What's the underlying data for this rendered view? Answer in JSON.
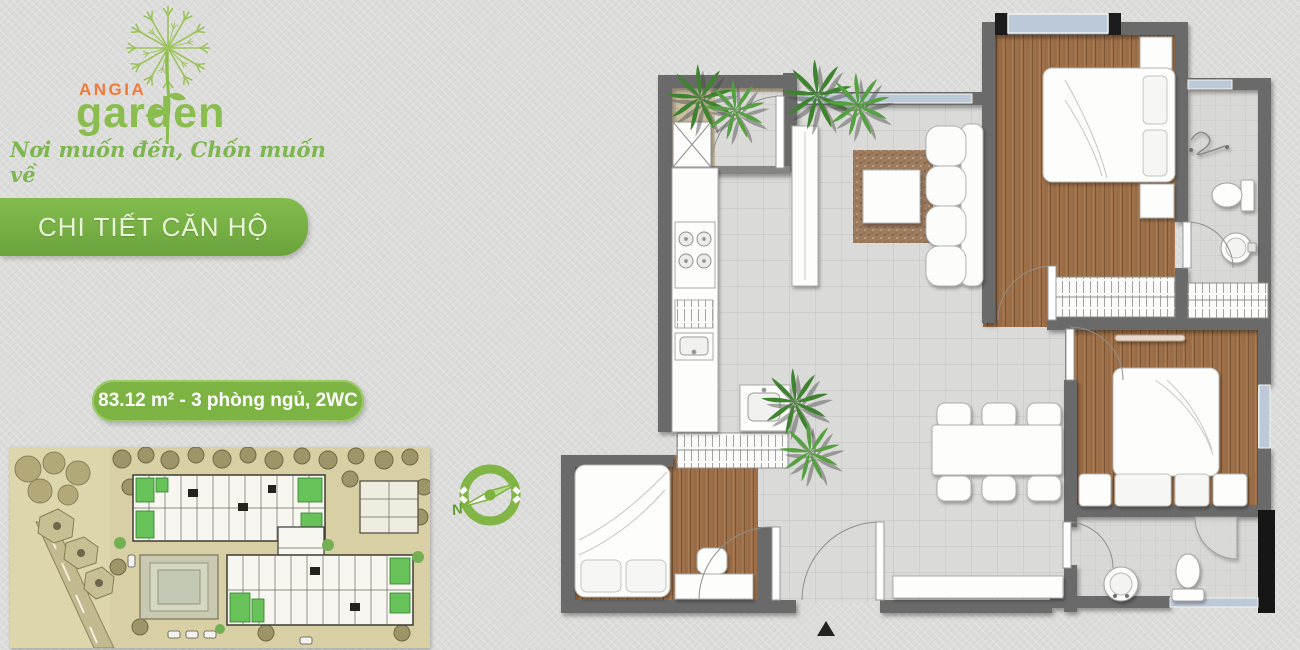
{
  "brand": {
    "logo_text_top": "ANGIA",
    "logo_text_bottom": "garden",
    "slogan": "Nơi muốn đến, Chốn muốn về"
  },
  "section_banner": {
    "label": "CHI TIẾT CĂN HỘ"
  },
  "unit_badge": {
    "label": "83.12 m² - 3 phòng ngủ, 2WC"
  },
  "compass": {
    "north_label": "N"
  },
  "icons": {
    "dandelion_logo": "dandelion-seed-head-with-stem",
    "compass": "green-ring-with-needle",
    "entrance_marker": "▲"
  },
  "colors": {
    "brand_green": "#8bbc4e",
    "brand_orange": "#ed7a3c",
    "banner_green": "#76b043",
    "badge_green": "#7cb342",
    "wall_gray": "#6b6b6b",
    "wood_floor": "#9b6f48",
    "tile_floor": "#dadad8",
    "balcony_tan": "#c9bda2",
    "window_blue": "#b9c9da",
    "siteplan_tan": "#d8d0a4",
    "background": "#dcdcda"
  }
}
